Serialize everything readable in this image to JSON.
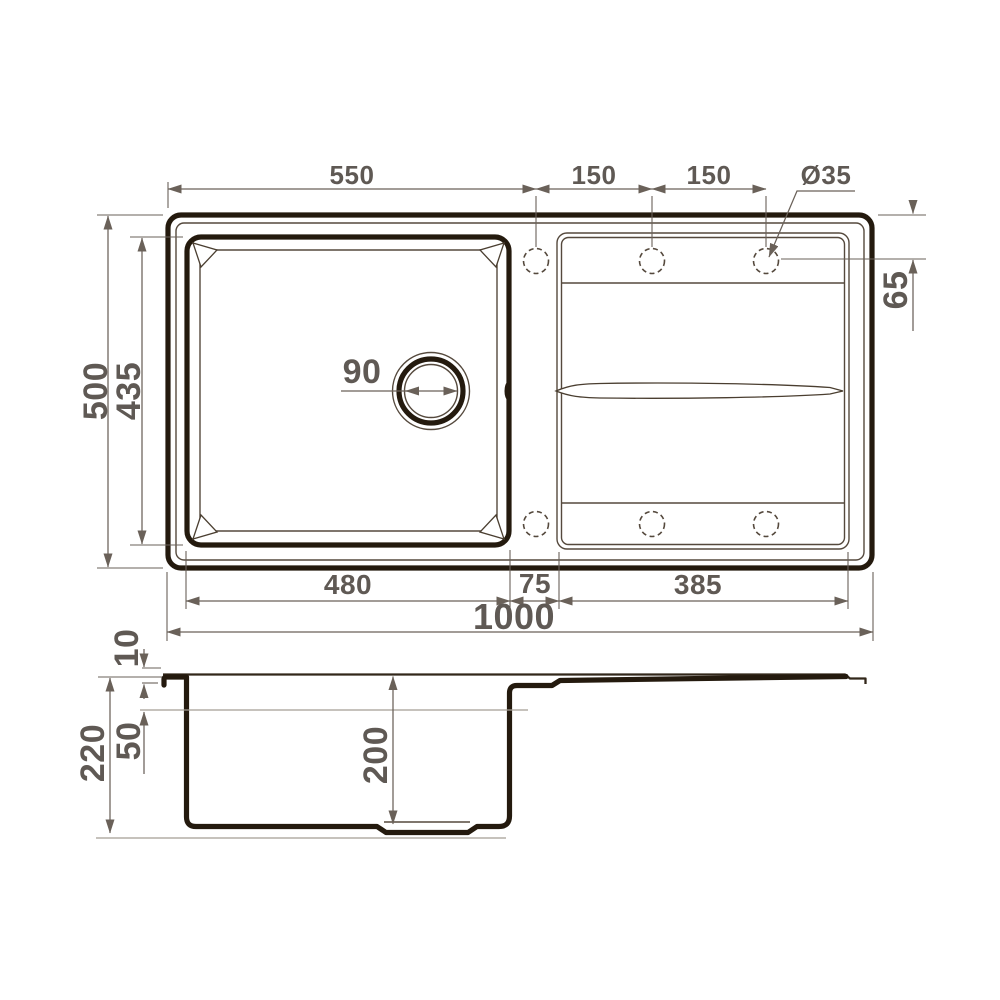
{
  "drawing": {
    "type": "technical-drawing",
    "subject": "kitchen sink with bowl and drainboard",
    "views": {
      "top": "plan view",
      "side": "section view"
    }
  },
  "dims": {
    "top_edge_to_hole": "550",
    "hole_spacing_1": "150",
    "hole_spacing_2": "150",
    "hole_diameter": "Ø35",
    "hole_edge_offset": "65",
    "overall_depth": "500",
    "bowl_depth": "435",
    "drain_diameter": "90",
    "bowl_width": "480",
    "gap_width": "75",
    "drainboard_width": "385",
    "overall_width": "1000",
    "rim_height": "10",
    "waterline_depth": "50",
    "total_height": "220",
    "bowl_inner_depth": "200"
  }
}
